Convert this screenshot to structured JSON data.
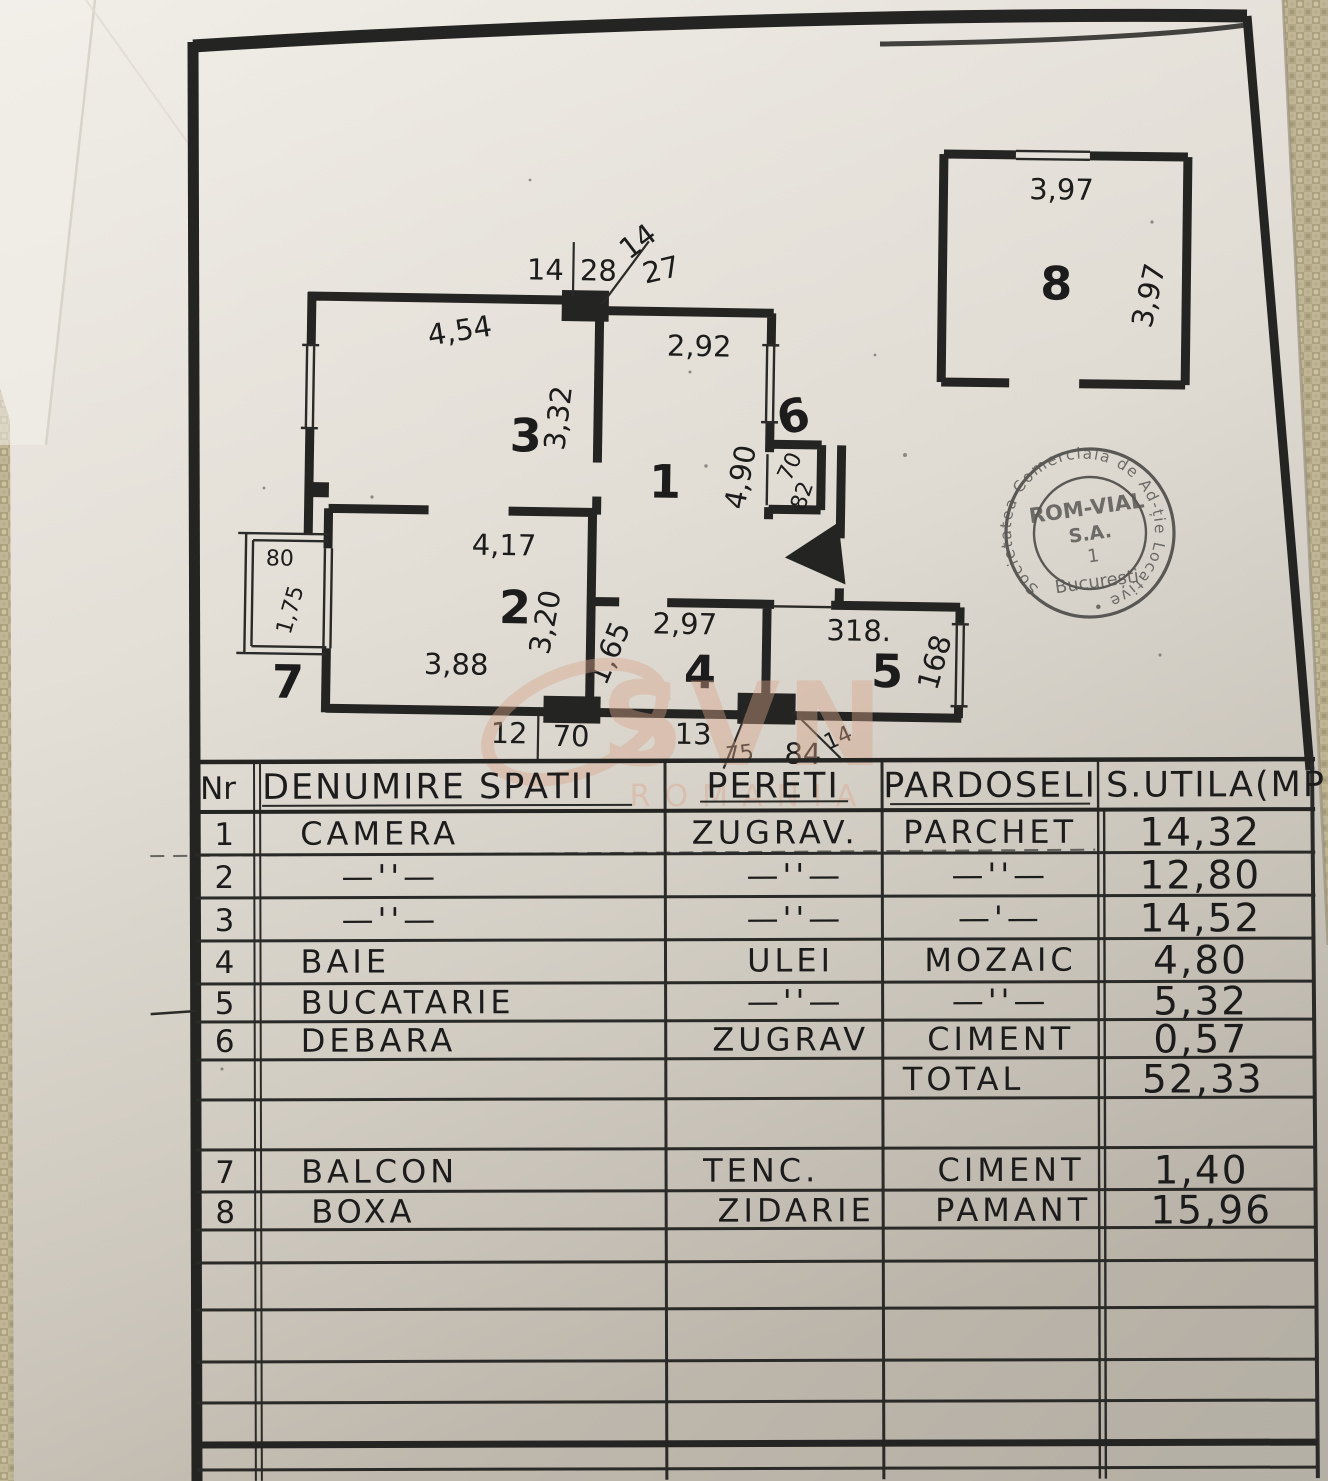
{
  "palette": {
    "paper": "#e7e3db",
    "ink": "#242422",
    "background_weave": "#bdb293",
    "stamp_ink": "#3d3d3b",
    "watermark": "#d9a58b"
  },
  "plan": {
    "room_labels": {
      "one": "1",
      "two": "2",
      "three": "3",
      "four": "4",
      "five": "5",
      "six": "6",
      "seven": "7",
      "eight": "8"
    },
    "dims": {
      "t14a": "14",
      "t28": "28",
      "t14b": "14",
      "t27": "27",
      "w454": "4,54",
      "w292": "2,92",
      "w332": "3,32",
      "w490": "4,90",
      "w70": "70",
      "w82": "82",
      "w417": "4,17",
      "w320": "3,20",
      "w165": "1,65",
      "w297": "2,97",
      "w318": "318.",
      "w168": "168",
      "w388": "3,88",
      "balc80": "80",
      "balc175": "1,75",
      "b12": "12",
      "b70": "70",
      "b13": "13",
      "b75": "75",
      "b84": "84",
      "b14": "14",
      "r8top": "3,97",
      "r8right": "3,97"
    }
  },
  "stamp": {
    "ring": "Societatea Comercială de Ad-ție Locative •",
    "l1": "ROM-VIAL",
    "l2": "S.A.",
    "l3": "1",
    "l4": "București"
  },
  "watermark": {
    "brand": "SVN",
    "region": "ROMANIA"
  },
  "table": {
    "headers": {
      "nr": "Nr",
      "denumire": "DENUMIRE SPATII",
      "pereti": "PERETI",
      "pardoseli": "PARDOSELI",
      "sutila": "S.UTILA(MP"
    },
    "rows": [
      {
        "nr": "1",
        "denumire": "CAMERA",
        "pereti": "ZUGRAV.",
        "pardoseli": "PARCHET",
        "sutila": "14,32"
      },
      {
        "nr": "2",
        "denumire": "—''—",
        "pereti": "—''—",
        "pardoseli": "—''—",
        "sutila": "12,80"
      },
      {
        "nr": "3",
        "denumire": "—''—",
        "pereti": "—''—",
        "pardoseli": "—'—",
        "sutila": "14,52"
      },
      {
        "nr": "4",
        "denumire": "BAIE",
        "pereti": "ULEI",
        "pardoseli": "MOZAIC",
        "sutila": "4,80"
      },
      {
        "nr": "5",
        "denumire": "BUCATARIE",
        "pereti": "—''—",
        "pardoseli": "—''—",
        "sutila": "5,32"
      },
      {
        "nr": "6",
        "denumire": "DEBARA",
        "pereti": "ZUGRAV",
        "pardoseli": "CIMENT",
        "sutila": "0,57"
      },
      {
        "nr": "",
        "denumire": "",
        "pereti": "",
        "pardoseli": "TOTAL",
        "sutila": "52,33"
      },
      {
        "nr": "7",
        "denumire": "BALCON",
        "pereti": "TENC.",
        "pardoseli": "CIMENT",
        "sutila": "1,40"
      },
      {
        "nr": "8",
        "denumire": "BOXA",
        "pereti": "ZIDARIE",
        "pardoseli": "PAMANT",
        "sutila": "15,96"
      }
    ]
  }
}
